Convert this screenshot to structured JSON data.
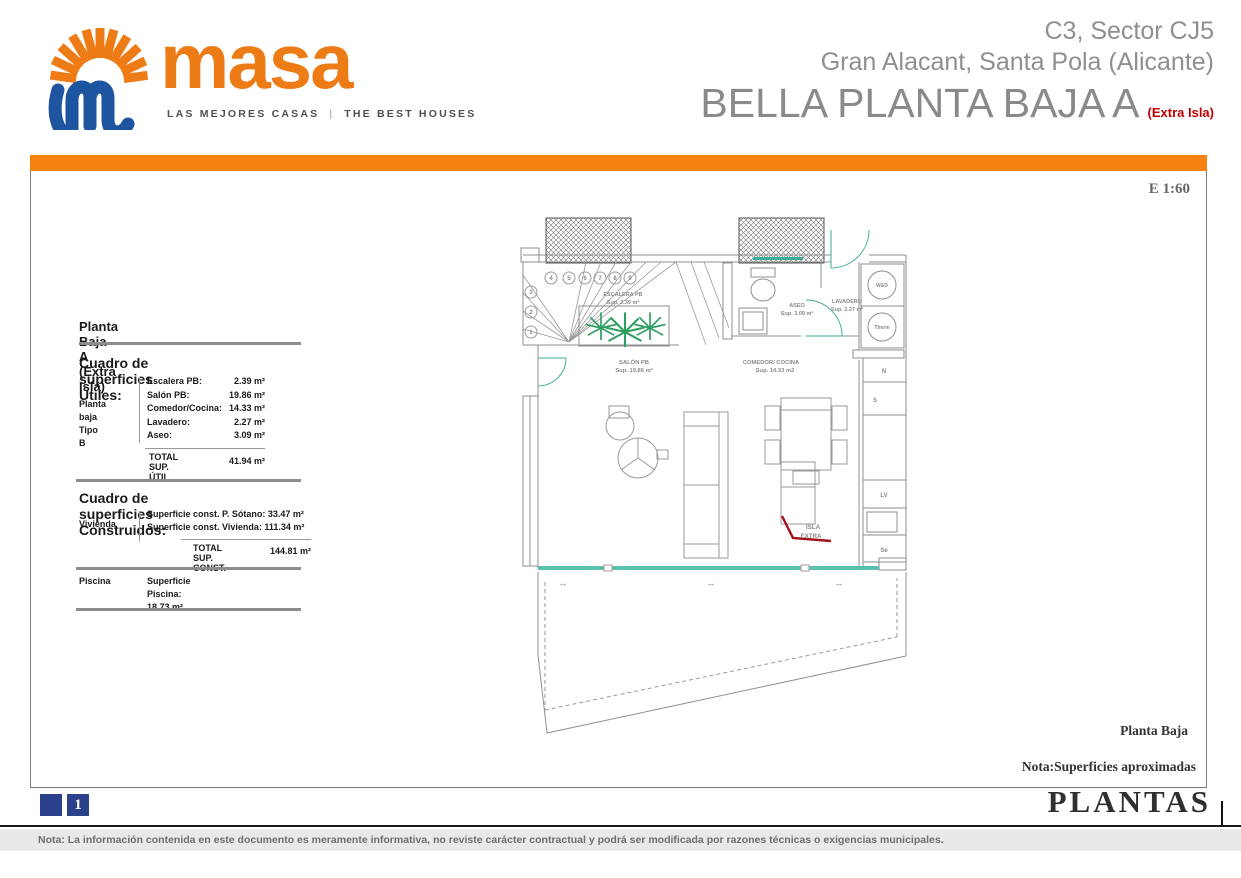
{
  "colors": {
    "orange": "#f5830d",
    "logo_orange": "#ee7c16",
    "logo_blue": "#1d55a0",
    "header_gray": "#8a8a8a",
    "accent_red": "#c00000",
    "navy": "#2c418c",
    "teal": "#4fb3a1",
    "palm_green": "#2f9e62"
  },
  "header": {
    "brand": "masa",
    "tagline_left": "LAS MEJORES CASAS",
    "tagline_sep": "|",
    "tagline_right": "THE BEST HOUSES",
    "project_line1": "C3, Sector CJ5",
    "project_line2": "Gran Alacant, Santa Pola (Alicante)",
    "sheet_title": "BELLA PLANTA BAJA A",
    "sheet_title_note": "(Extra Isla)"
  },
  "sheet": {
    "scale": "E 1:60",
    "plan_caption": "Planta Baja",
    "approx_note": "Nota:Superficies aproximadas"
  },
  "surfaces_panel": {
    "title": "Planta Baja A (Extra Isla)",
    "utiles": {
      "heading": "Cuadro de superficies Útiles:",
      "group_label_line1": "Planta baja",
      "group_label_line2": "Tipo B",
      "rows": [
        {
          "label": "Escalera PB:",
          "value": "2.39 m²"
        },
        {
          "label": "Salón PB:",
          "value": "19.86 m²"
        },
        {
          "label": "Comedor/Cocina:",
          "value": "14.33 m²"
        },
        {
          "label": "Lavadero:",
          "value": "2.27 m²"
        },
        {
          "label": "Aseo:",
          "value": "3.09 m²"
        }
      ],
      "total_label_line1": "TOTAL",
      "total_label_line2": "SUP. ÚTIL",
      "total_value": "41.94 m²"
    },
    "construidas": {
      "heading": "Cuadro de superficies Construidos:",
      "group_label": "Vivienda",
      "rows": [
        "Superficie const. P. Sótano: 33.47 m²",
        "Superficie const. Vivienda: 111.34 m²"
      ],
      "total_label_line1": "TOTAL",
      "total_label_line2": "SUP. CONST.",
      "total_value": "144.81 m²",
      "piscina_label": "Piscina",
      "piscina_value": "Superficie Piscina: 18.73 m²"
    }
  },
  "plan": {
    "rooms": {
      "escalera_name": "ESCALERA PB",
      "escalera_sup": "Sup. 2.39 m²",
      "salon_name": "SALÓN PB",
      "salon_sup": "Sup. 19.86 m²",
      "comedor_name": "COMEDOR/ COCINA",
      "comedor_sup": "Sup. 14.33 m2",
      "aseo_name": "ASEO",
      "aseo_sup": "Sup. 3.09 m²",
      "lavadero_name": "LAVADERO",
      "lavadero_sup": "Sup. 2.27 m²"
    },
    "island_note_line1": "ISLA",
    "island_note_line2": "EXTRA",
    "appliances": {
      "washer": "W&D",
      "thermo": "Therm",
      "fridge": "N",
      "s_unit": "S",
      "dishwasher": "LV",
      "dryer": "Se"
    },
    "stairs": {
      "top": [
        "4",
        "5",
        "6",
        "7",
        "8",
        "9"
      ],
      "left": [
        "3",
        "2",
        "1"
      ]
    },
    "slide_arrow": "↔"
  },
  "footer": {
    "page_number": "1",
    "section_title": "PLANTAS",
    "disclaimer": "Nota: La información contenida en este documento es meramente informativa, no reviste carácter contractual y podrá ser modificada por razones técnicas o exigencias municipales."
  }
}
